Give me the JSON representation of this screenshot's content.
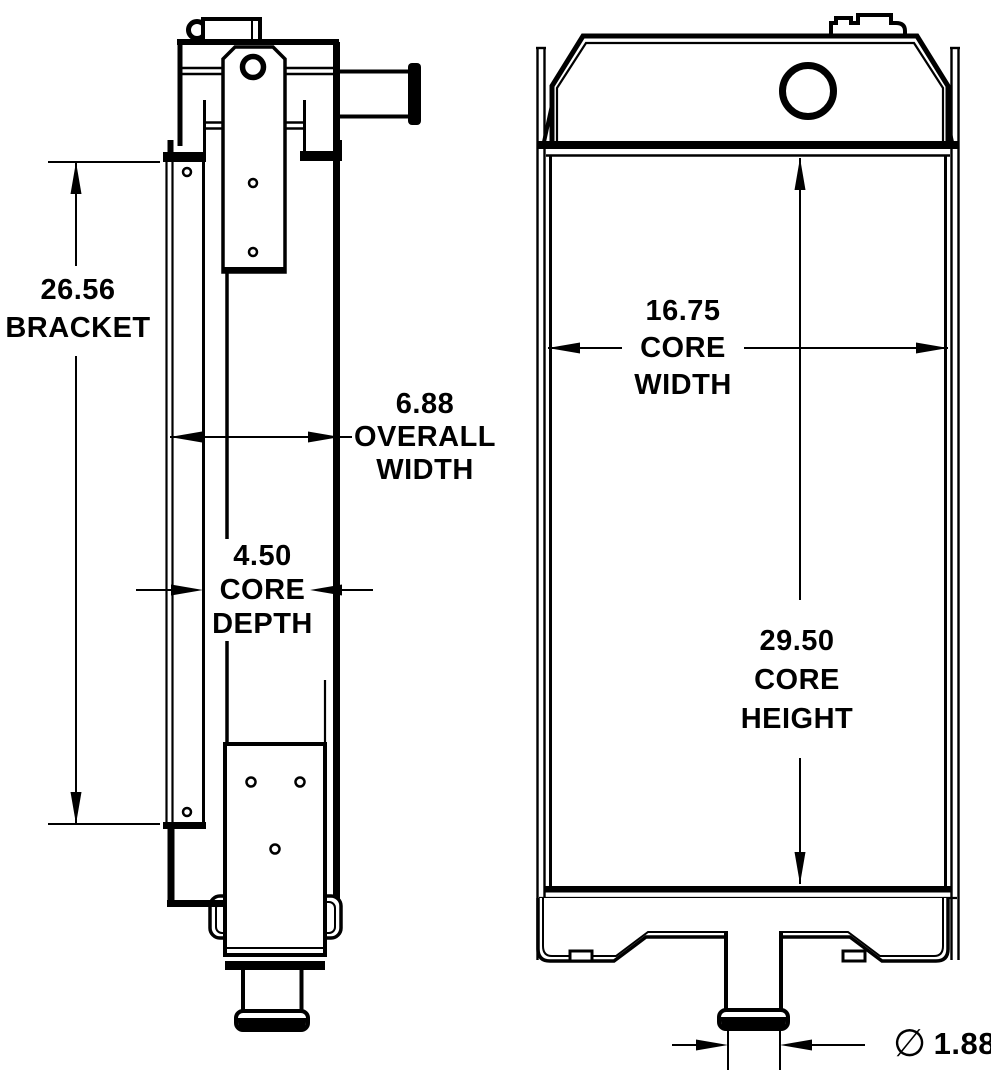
{
  "drawing": {
    "colors": {
      "background": "#ffffff",
      "line": "#000000"
    },
    "dimensions": {
      "bracket": {
        "value": "26.56",
        "label": "BRACKET"
      },
      "overall_width": {
        "value": "6.88",
        "label_line1": "OVERALL",
        "label_line2": "WIDTH"
      },
      "core_depth": {
        "value": "4.50",
        "label_line1": "CORE",
        "label_line2": "DEPTH"
      },
      "core_width": {
        "value": "16.75",
        "label_line1": "CORE",
        "label_line2": "WIDTH"
      },
      "core_height": {
        "value": "29.50",
        "label_line1": "CORE",
        "label_line2": "HEIGHT"
      },
      "outlet_diameter": {
        "symbol": "∅",
        "value": "1.88"
      }
    }
  }
}
